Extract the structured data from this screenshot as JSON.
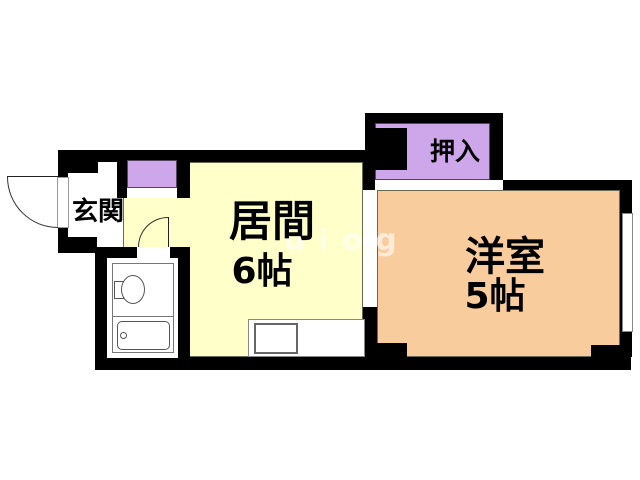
{
  "plan": {
    "type": "apartment-floorplan",
    "rooms": {
      "genkan": {
        "label": "玄関"
      },
      "living": {
        "label": "居間",
        "size": "6帖",
        "color": "#ffffc9"
      },
      "western": {
        "label": "洋室",
        "size": "5帖",
        "color": "#f9cc9d"
      },
      "closet": {
        "label": "押入",
        "color": "#cda7e9"
      },
      "shoebox": {
        "color": "#cda7e9"
      }
    },
    "fixtures": [
      "toilet",
      "bathtub",
      "kitchen-sink",
      "entrance-door",
      "bathroom-door",
      "window"
    ],
    "colors": {
      "wall": "#000000",
      "room_border": "#6a6a50",
      "living_fill": "#ffffc9",
      "western_fill": "#f9cc9d",
      "closet_fill": "#cda7e9",
      "background": "#ffffff"
    },
    "watermark": "uiog"
  }
}
